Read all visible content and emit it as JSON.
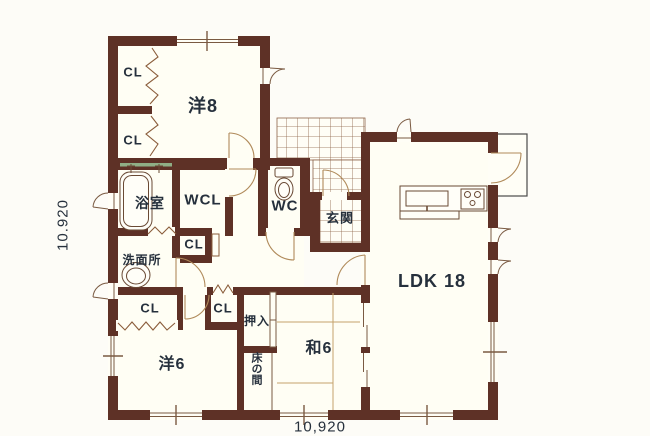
{
  "floorplan": {
    "title": "house-floor-plan",
    "labels": {
      "closet": "CL",
      "western8": "洋8",
      "bath": "浴室",
      "walk_in_closet": "WCL",
      "toilet": "WC",
      "entrance": "玄関",
      "washroom": "洗面所",
      "ldk": "LDK 18",
      "oshiire": "押入",
      "tokonoma": "床の間",
      "western6": "洋6",
      "japanese6": "和6"
    },
    "dimensions": {
      "vertical": "10.920",
      "horizontal": "10,920"
    },
    "colors": {
      "wall": "#5e3126",
      "thin_line": "#7a5a42",
      "door_arc": "#b08a5a",
      "text": "#26303c",
      "paper": "#fdfcf7",
      "tatami_line": "#c4a26b"
    }
  }
}
